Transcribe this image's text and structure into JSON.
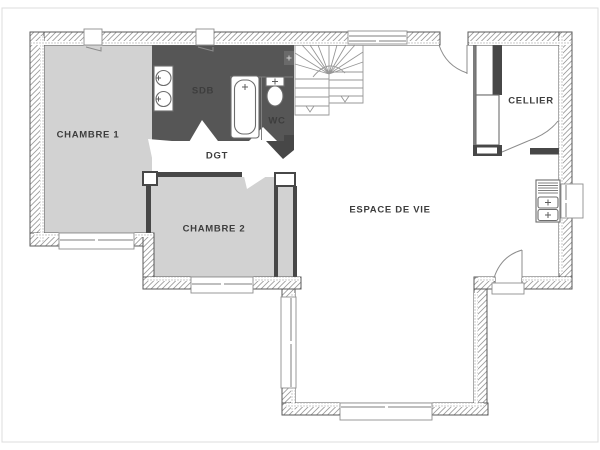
{
  "plan": {
    "title": "floor-plan",
    "labels": {
      "chambre1": "CHAMBRE 1",
      "sdb": "SDB",
      "wc": "WC",
      "dgt": "DGT",
      "chambre2": "CHAMBRE 2",
      "espace_de_vie": "ESPACE DE VIE",
      "cellier": "CELLIER"
    },
    "colors": {
      "background": "#ffffff",
      "room_fill": "#d2d2d2",
      "wet_room_fill": "#565656",
      "wall_dark": "#474747",
      "outline": "#5a5a5a",
      "hatch_line": "#9a9a9a",
      "stipple": "#bdbdbd",
      "thin_line": "#8c8c8c",
      "label_text": "#3d3d3d",
      "frame_border": "#dcdcdc"
    }
  }
}
